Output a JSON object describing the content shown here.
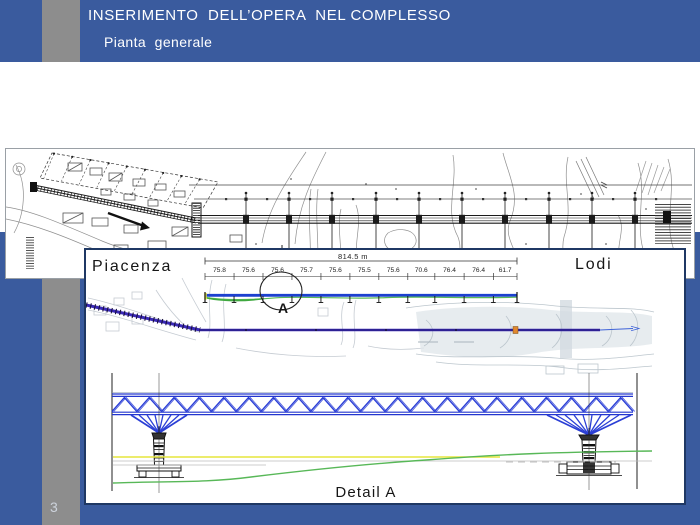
{
  "header": {
    "title": "INSERIMENTO  DELL’OPERA  NEL COMPLESSO",
    "subtitle": "Pianta  generale"
  },
  "page_number": "3",
  "bottom_panel": {
    "left_city": "Piacenza",
    "right_city": "Lodi",
    "total_length_label": "814.5 m",
    "total_length_m": 814.5,
    "span_labels": [
      "75.8",
      "75.6",
      "75.6",
      "75.7",
      "75.6",
      "75.5",
      "75.6",
      "70.6",
      "76.4",
      "76.4",
      "61.7"
    ],
    "span_lengths_m": [
      75.8,
      75.6,
      75.6,
      75.7,
      75.6,
      75.5,
      75.6,
      70.6,
      76.4,
      76.4,
      61.7
    ],
    "detail_marker_label": "A",
    "detail_caption": "Detail A"
  },
  "colors": {
    "background_blue": "#3a5b9e",
    "panel_border_navy": "#1f3864",
    "side_band_gray": "#8d8d8d",
    "truss_blue": "#2b3fd6",
    "alignment_purple": "#3a28b8",
    "elevation_blue": "#1c40cf",
    "ground_green": "#58b858",
    "level_yellow": "#e6e63c",
    "marker_orange": "#e0872f"
  }
}
